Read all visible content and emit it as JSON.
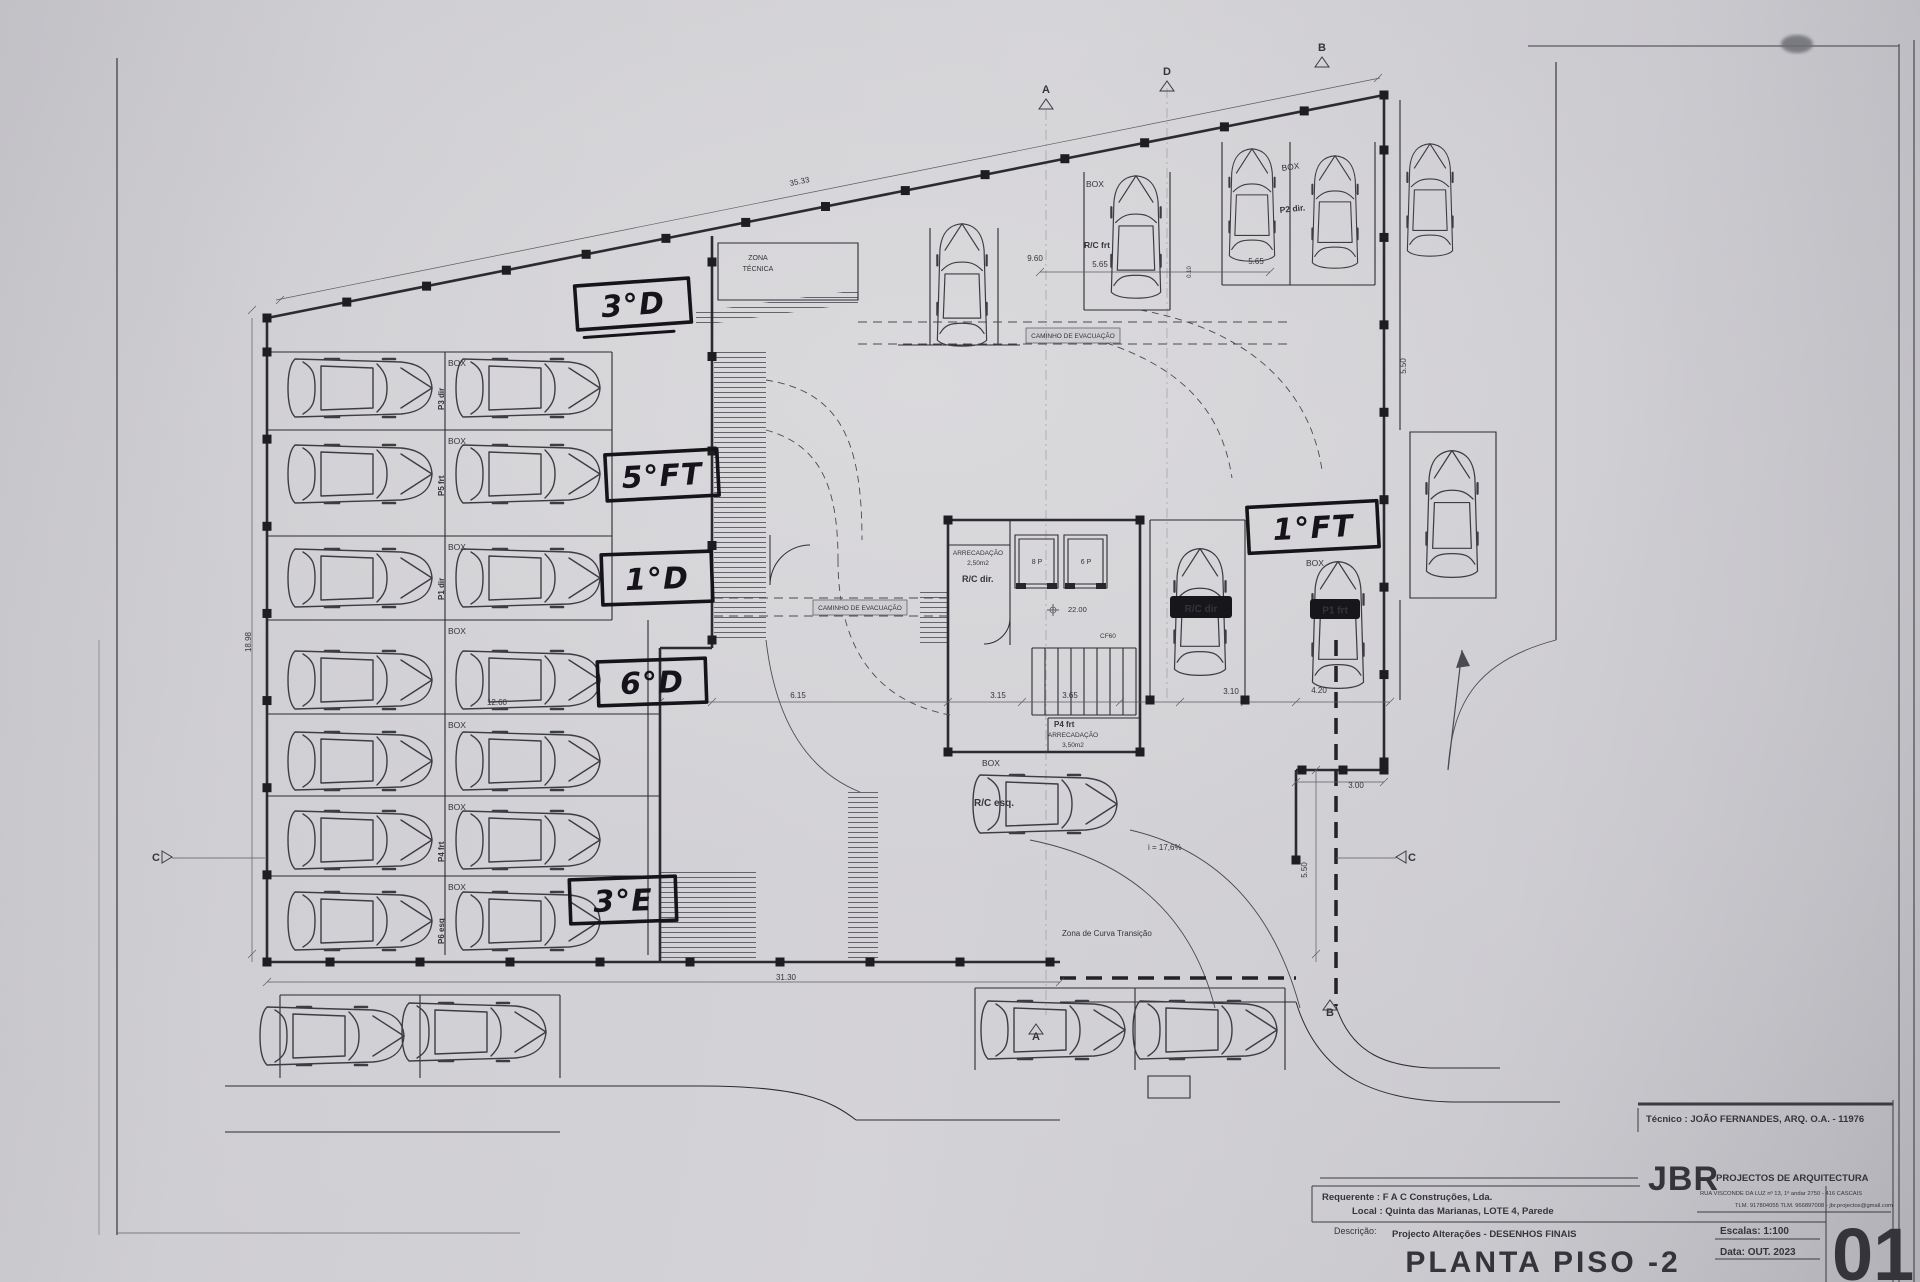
{
  "title_block": {
    "technician": "Técnico : JOÃO FERNANDES, ARQ.   O.A. - 11976",
    "client": "Requerente : F A C  Construções, Lda.",
    "location": "Local : Quinta das Marianas, LOTE 4, Parede",
    "description_label": "Descrição:",
    "description": "Projecto Alterações - DESENHOS FINAIS",
    "sheet_title": "PLANTA PISO -2",
    "firm_logo": "JBR",
    "firm_name": "PROJECTOS DE ARQUITECTURA",
    "firm_address": "RUA VISCONDE DA LUZ nº 13, 1º andar  2750 - 416  CASCAIS",
    "firm_contacts": "TLM. 917804055  TLM. 966897008 - jbr.projectos@gmail.com",
    "scale": "Escalas:  1:100",
    "date": "Data:  OUT.  2023",
    "sheet_number": "01"
  },
  "colors": {
    "ink": "#3a3a41",
    "heavy_ink": "#26262c",
    "marker": "#16141a",
    "paper": "#cfced2"
  },
  "handwritten_notes": [
    {
      "t": "3°D",
      "x": 576,
      "y": 282,
      "w": 114,
      "h": 44,
      "r": -4,
      "underline": true
    },
    {
      "t": "5°FT",
      "x": 606,
      "y": 452,
      "w": 112,
      "h": 46,
      "r": -3
    },
    {
      "t": "1°D",
      "x": 602,
      "y": 553,
      "w": 110,
      "h": 50,
      "r": -2
    },
    {
      "t": "6°D",
      "x": 598,
      "y": 660,
      "w": 108,
      "h": 44,
      "r": -2
    },
    {
      "t": "3°E",
      "x": 570,
      "y": 878,
      "w": 106,
      "h": 44,
      "r": -2
    },
    {
      "t": "1°FT",
      "x": 1248,
      "y": 504,
      "w": 130,
      "h": 46,
      "r": -3
    }
  ],
  "plan": {
    "labels": [
      {
        "t": "BOX",
        "x": 448,
        "y": 366
      },
      {
        "t": "BOX",
        "x": 448,
        "y": 444
      },
      {
        "t": "BOX",
        "x": 448,
        "y": 550
      },
      {
        "t": "BOX",
        "x": 448,
        "y": 634
      },
      {
        "t": "BOX",
        "x": 448,
        "y": 728
      },
      {
        "t": "BOX",
        "x": 448,
        "y": 810
      },
      {
        "t": "BOX",
        "x": 448,
        "y": 890
      },
      {
        "t": "BOX",
        "x": 1086,
        "y": 187
      },
      {
        "t": "BOX",
        "x": 1282,
        "y": 171,
        "r": -8
      },
      {
        "t": "BOX",
        "x": 1306,
        "y": 566
      },
      {
        "t": "BOX",
        "x": 982,
        "y": 766
      },
      {
        "t": "P3 dir",
        "x": 444,
        "y": 410,
        "r": -90,
        "s": 8,
        "b": 1
      },
      {
        "t": "P5 frt",
        "x": 444,
        "y": 496,
        "r": -90,
        "s": 8,
        "b": 1
      },
      {
        "t": "P1 dir",
        "x": 444,
        "y": 600,
        "r": -90,
        "s": 8,
        "b": 1
      },
      {
        "t": "P4 frt",
        "x": 444,
        "y": 862,
        "r": -90,
        "s": 8,
        "b": 1
      },
      {
        "t": "P6 esq",
        "x": 444,
        "y": 944,
        "r": -90,
        "s": 8,
        "b": 1
      },
      {
        "t": "R/C frt",
        "x": 1084,
        "y": 248,
        "s": 8.5,
        "b": 1
      },
      {
        "t": "P2 dir.",
        "x": 1280,
        "y": 213,
        "s": 8.5,
        "b": 1,
        "r": -6
      },
      {
        "t": "R/C esq.",
        "x": 974,
        "y": 806,
        "s": 10,
        "b": 1
      },
      {
        "t": "R/C dir.",
        "x": 962,
        "y": 582,
        "s": 9,
        "b": 1
      },
      {
        "t": "P4 frt",
        "x": 1054,
        "y": 727,
        "s": 8,
        "b": 1
      },
      {
        "t": "ZONA",
        "x": 758,
        "y": 260,
        "s": 7,
        "a": "m"
      },
      {
        "t": "TÉCNICA",
        "x": 758,
        "y": 271,
        "s": 7,
        "a": "m"
      },
      {
        "t": "ARRECADAÇÃO",
        "x": 978,
        "y": 555,
        "s": 6.5,
        "a": "m"
      },
      {
        "t": "2,50m2",
        "x": 978,
        "y": 565,
        "s": 6.5,
        "a": "m"
      },
      {
        "t": "ARRECADAÇÃO",
        "x": 1073,
        "y": 737,
        "s": 6.5,
        "a": "m"
      },
      {
        "t": "3,50m2",
        "x": 1073,
        "y": 747,
        "s": 6.5,
        "a": "m"
      },
      {
        "t": "CAMINHO DE EVACUAÇÃO",
        "x": 1073,
        "y": 338,
        "s": 6.5,
        "a": "m"
      },
      {
        "t": "CAMINHO DE EVACUAÇÃO",
        "x": 860,
        "y": 610,
        "s": 6.5,
        "a": "m"
      },
      {
        "t": "Zona de Curva Transição",
        "x": 1062,
        "y": 936,
        "s": 8
      },
      {
        "t": "i = 17,6%",
        "x": 1148,
        "y": 850,
        "s": 8
      },
      {
        "t": "CF60",
        "x": 1100,
        "y": 638,
        "s": 6.5
      },
      {
        "t": "8 P",
        "x": 1037,
        "y": 564,
        "s": 7,
        "a": "m"
      },
      {
        "t": "6 P",
        "x": 1086,
        "y": 564,
        "s": 7,
        "a": "m"
      }
    ],
    "badges": [
      {
        "t": "R/C dir",
        "bx": 1170,
        "by": 596,
        "w": 62,
        "h": 22
      },
      {
        "t": "P1 frt",
        "bx": 1310,
        "by": 599,
        "w": 50,
        "h": 20
      }
    ],
    "dimensions": [
      {
        "t": "35.33",
        "x": 800,
        "y": 184,
        "r": -11.5,
        "a": "m"
      },
      {
        "t": "9.60",
        "x": 1035,
        "y": 261,
        "a": "m"
      },
      {
        "t": "5.65",
        "x": 1100,
        "y": 267,
        "a": "m"
      },
      {
        "t": "5.65",
        "x": 1256,
        "y": 264,
        "a": "m"
      },
      {
        "t": "0.10",
        "x": 1191,
        "y": 272,
        "r": -90,
        "s": 6,
        "a": "m"
      },
      {
        "t": "31.30",
        "x": 786,
        "y": 980,
        "a": "m"
      },
      {
        "t": "12.60",
        "x": 497,
        "y": 705,
        "a": "m"
      },
      {
        "t": "6.15",
        "x": 798,
        "y": 698,
        "a": "m"
      },
      {
        "t": "3.15",
        "x": 998,
        "y": 698,
        "a": "m"
      },
      {
        "t": "3.65",
        "x": 1070,
        "y": 698,
        "a": "m"
      },
      {
        "t": "3.10",
        "x": 1231,
        "y": 694,
        "a": "m"
      },
      {
        "t": "4.20",
        "x": 1319,
        "y": 693,
        "a": "m"
      },
      {
        "t": "3.00",
        "x": 1356,
        "y": 788,
        "a": "m"
      },
      {
        "t": "5.50",
        "x": 1307,
        "y": 870,
        "r": -90,
        "a": "m"
      },
      {
        "t": "5.50",
        "x": 1406,
        "y": 366,
        "r": -90,
        "a": "m"
      },
      {
        "t": "18.98",
        "x": 251,
        "y": 642,
        "r": -90,
        "a": "m"
      },
      {
        "t": "22.00",
        "x": 1068,
        "y": 612,
        "s": 7.5
      }
    ],
    "section_markers": [
      {
        "t": "A",
        "x": 1046,
        "y": 93,
        "dir": "down"
      },
      {
        "t": "D",
        "x": 1167,
        "y": 75,
        "dir": "down"
      },
      {
        "t": "B",
        "x": 1322,
        "y": 51,
        "dir": "down"
      },
      {
        "t": "C",
        "x": 156,
        "y": 861,
        "dir": "right"
      },
      {
        "t": "C",
        "x": 1412,
        "y": 861,
        "dir": "left"
      },
      {
        "t": "A",
        "x": 1036,
        "y": 1040,
        "dir": "up"
      },
      {
        "t": "B",
        "x": 1330,
        "y": 1016,
        "dir": "up"
      }
    ],
    "cars": [
      {
        "x": 360,
        "y": 388
      },
      {
        "x": 528,
        "y": 388
      },
      {
        "x": 360,
        "y": 474
      },
      {
        "x": 528,
        "y": 474
      },
      {
        "x": 360,
        "y": 578
      },
      {
        "x": 528,
        "y": 578
      },
      {
        "x": 360,
        "y": 680
      },
      {
        "x": 528,
        "y": 680
      },
      {
        "x": 360,
        "y": 761
      },
      {
        "x": 528,
        "y": 761
      },
      {
        "x": 360,
        "y": 840
      },
      {
        "x": 528,
        "y": 840
      },
      {
        "x": 360,
        "y": 921
      },
      {
        "x": 528,
        "y": 921
      },
      {
        "x": 332,
        "y": 1036
      },
      {
        "x": 474,
        "y": 1032
      },
      {
        "x": 1053,
        "y": 1030
      },
      {
        "x": 1205,
        "y": 1030
      },
      {
        "x": 962,
        "y": 285,
        "r": -90,
        "s": 0.85
      },
      {
        "x": 1136,
        "y": 237,
        "r": -90,
        "s": 0.85
      },
      {
        "x": 1252,
        "y": 205,
        "r": -90,
        "s": 0.78
      },
      {
        "x": 1335,
        "y": 212,
        "r": -90,
        "s": 0.78
      },
      {
        "x": 1430,
        "y": 200,
        "r": -90,
        "s": 0.78
      },
      {
        "x": 1452,
        "y": 514,
        "r": -90,
        "s": 0.88
      },
      {
        "x": 1200,
        "y": 612,
        "r": -90,
        "s": 0.88
      },
      {
        "x": 1338,
        "y": 625,
        "r": -90,
        "s": 0.88
      },
      {
        "x": 1045,
        "y": 804
      }
    ]
  }
}
